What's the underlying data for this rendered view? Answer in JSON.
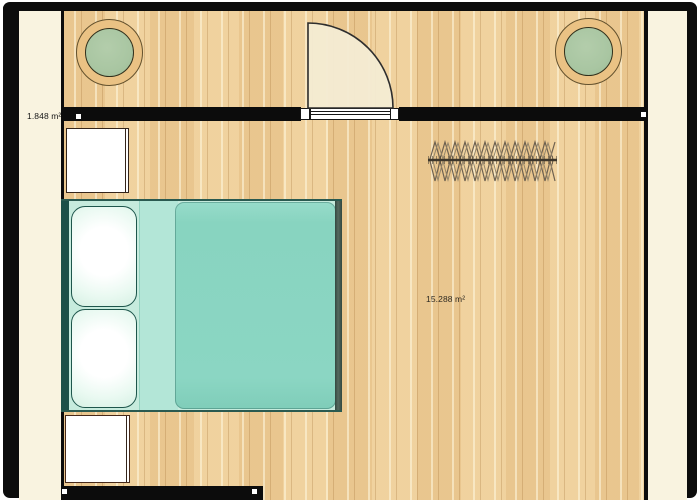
{
  "plan": {
    "rooms": [
      {
        "id": "hallway",
        "area_label": "1.848 m²"
      },
      {
        "id": "bedroom",
        "area_label": "15.288 m²"
      }
    ],
    "furniture": [
      {
        "name": "potted-plant-left"
      },
      {
        "name": "potted-plant-right"
      },
      {
        "name": "interior-door"
      },
      {
        "name": "clothes-rail"
      },
      {
        "name": "double-bed"
      },
      {
        "name": "nightstand-top"
      },
      {
        "name": "nightstand-bottom"
      }
    ],
    "colors": {
      "wall": "#0c0c0c",
      "floor": "#eecd97",
      "floor_grain": "#9a672a",
      "margin": "#f9f3e0",
      "duvet": "#8bd6c3",
      "sheet": "#b3e6d7",
      "pillow": "#f7fffb",
      "bed_frame": "#1c5048",
      "plant_pot": "#eac284",
      "plant_leaves": "#a9c6a2",
      "door_leaf": "#f4ebd2"
    }
  }
}
